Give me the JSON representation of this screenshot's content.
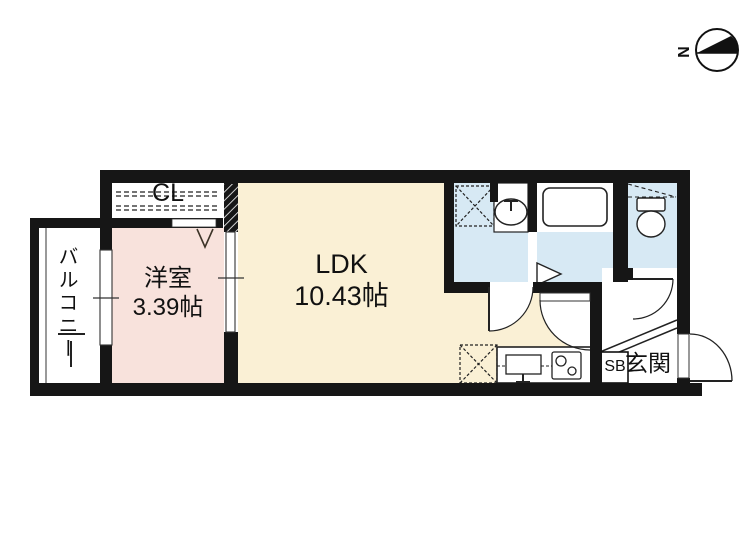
{
  "plan": {
    "rooms": {
      "balcony": {
        "label": "バルコニー"
      },
      "western_room": {
        "label": "洋室",
        "size": "3.39帖"
      },
      "ldk": {
        "label": "LDK",
        "size": "10.43帖"
      },
      "closet": {
        "label": "CL"
      },
      "entrance": {
        "label": "玄関"
      },
      "shoe_box": {
        "label": "SB"
      }
    },
    "compass": {
      "north_label": "N"
    },
    "fixtures": [
      "washing-machine-space",
      "washbasin",
      "bathtub",
      "toilet",
      "kitchen-sink",
      "stove",
      "refrigerator-space",
      "closet-hanger-pipes",
      "entry-step",
      "sliding-door",
      "window",
      "hinged-doors",
      "folding-door"
    ],
    "colors": {
      "wall": "#161616",
      "western_room_fill": "#f8e2dc",
      "ldk_fill": "#faf0d5",
      "wet_area_fill": "#d7e9f4",
      "background": "#ffffff"
    }
  }
}
